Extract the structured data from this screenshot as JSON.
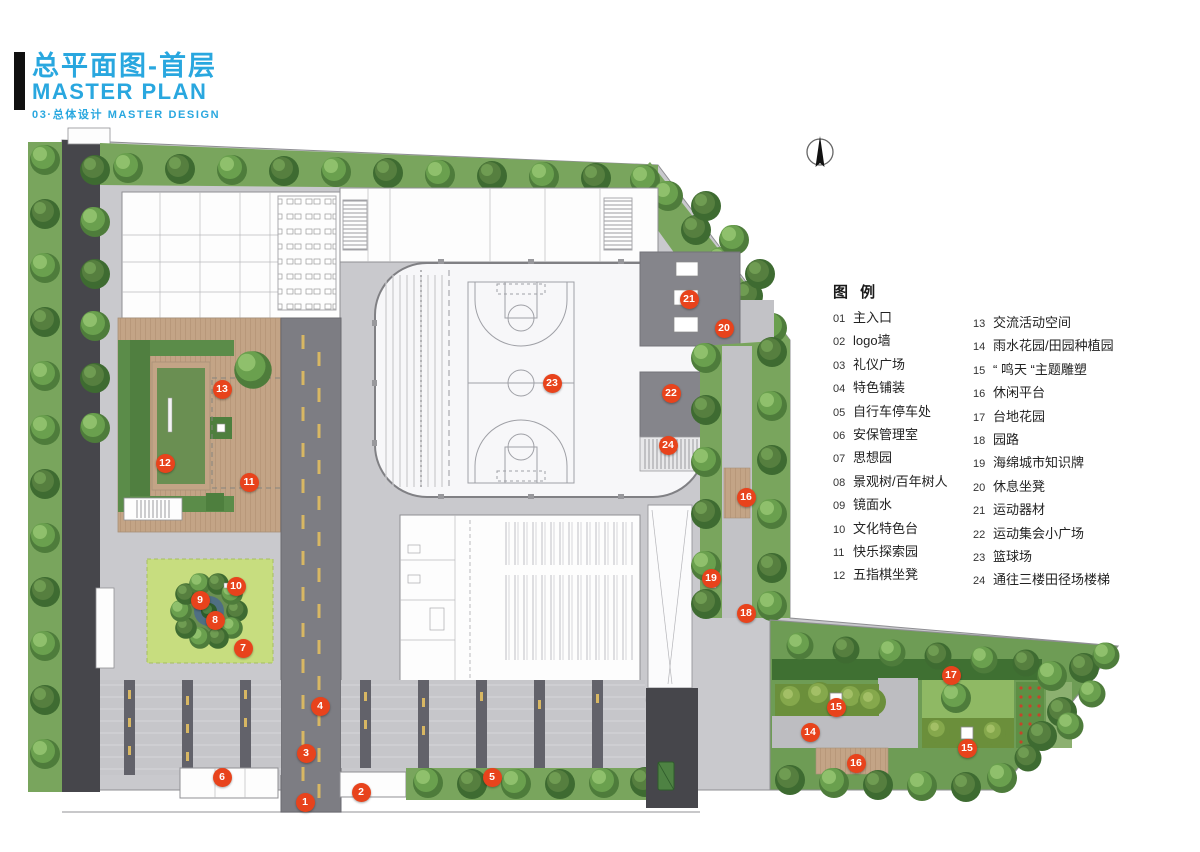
{
  "title": {
    "cn": "总平面图-首层",
    "en": "MASTER PLAN",
    "sub": "03·总体设计  MASTER DESIGN"
  },
  "legend": {
    "header": "图 例",
    "col1": [
      {
        "num": "01",
        "label": "主入口"
      },
      {
        "num": "02",
        "label": "logo墙"
      },
      {
        "num": "03",
        "label": "礼仪广场"
      },
      {
        "num": "04",
        "label": "特色铺装"
      },
      {
        "num": "05",
        "label": "自行车停车处"
      },
      {
        "num": "06",
        "label": "安保管理室"
      },
      {
        "num": "07",
        "label": "思想园"
      },
      {
        "num": "08",
        "label": "景观树/百年树人"
      },
      {
        "num": "09",
        "label": "镜面水"
      },
      {
        "num": "10",
        "label": "文化特色台"
      },
      {
        "num": "11",
        "label": "快乐探索园"
      },
      {
        "num": "12",
        "label": "五指棋坐凳"
      }
    ],
    "col2": [
      {
        "num": "13",
        "label": "交流活动空间"
      },
      {
        "num": "14",
        "label": "雨水花园/田园种植园"
      },
      {
        "num": "15",
        "label": "“ 鸣天 “主题雕塑"
      },
      {
        "num": "16",
        "label": "休闲平台"
      },
      {
        "num": "17",
        "label": "台地花园"
      },
      {
        "num": "18",
        "label": "园路"
      },
      {
        "num": "19",
        "label": "海绵城市知识牌"
      },
      {
        "num": "20",
        "label": "休息坐凳"
      },
      {
        "num": "21",
        "label": "运动器材"
      },
      {
        "num": "22",
        "label": "运动集会小广场"
      },
      {
        "num": "23",
        "label": "篮球场"
      },
      {
        "num": "24",
        "label": "通往三楼田径场楼梯"
      }
    ]
  },
  "plan": {
    "markers": [
      {
        "n": "1",
        "x": 305,
        "y": 802
      },
      {
        "n": "2",
        "x": 361,
        "y": 792
      },
      {
        "n": "3",
        "x": 306,
        "y": 753
      },
      {
        "n": "4",
        "x": 320,
        "y": 706
      },
      {
        "n": "5",
        "x": 492,
        "y": 777
      },
      {
        "n": "6",
        "x": 222,
        "y": 777
      },
      {
        "n": "7",
        "x": 243,
        "y": 648
      },
      {
        "n": "8",
        "x": 215,
        "y": 620
      },
      {
        "n": "9",
        "x": 200,
        "y": 600
      },
      {
        "n": "10",
        "x": 236,
        "y": 586
      },
      {
        "n": "11",
        "x": 249,
        "y": 482
      },
      {
        "n": "12",
        "x": 165,
        "y": 463
      },
      {
        "n": "13",
        "x": 222,
        "y": 389
      },
      {
        "n": "14",
        "x": 810,
        "y": 732
      },
      {
        "n": "15",
        "x": 836,
        "y": 707
      },
      {
        "n": "15",
        "x": 967,
        "y": 748
      },
      {
        "n": "16",
        "x": 746,
        "y": 497
      },
      {
        "n": "16",
        "x": 856,
        "y": 763
      },
      {
        "n": "17",
        "x": 951,
        "y": 675
      },
      {
        "n": "18",
        "x": 746,
        "y": 613
      },
      {
        "n": "19",
        "x": 711,
        "y": 578
      },
      {
        "n": "20",
        "x": 724,
        "y": 328
      },
      {
        "n": "21",
        "x": 689,
        "y": 299
      },
      {
        "n": "22",
        "x": 671,
        "y": 393
      },
      {
        "n": "23",
        "x": 552,
        "y": 383
      },
      {
        "n": "24",
        "x": 668,
        "y": 445
      }
    ]
  },
  "colors": {
    "accent_blue": "#29A7DF",
    "marker_red": "#E8431C",
    "paving_light": "#C9C9CD",
    "plaza_dark": "#85858B",
    "road_asphalt": "#7D7D83",
    "perimeter_road": "#46464B",
    "lawn_green": "#C7DD7F",
    "hedge_green": "#79A55D",
    "tree_green": "#6AA04E",
    "deck_wood": "#C3A486",
    "mirror_water": "#4F6F83",
    "lane_dash_yellow": "#D8B763",
    "building_white": "#FDFDFD"
  }
}
